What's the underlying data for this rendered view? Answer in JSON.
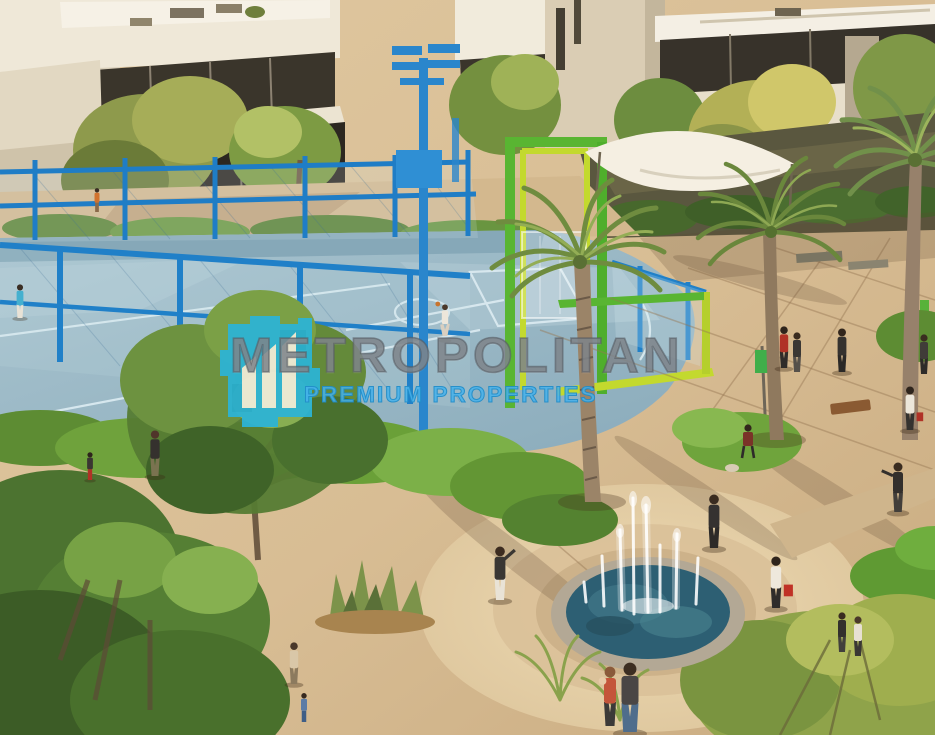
{
  "image": {
    "description": "Aerial architectural rendering of a residential community plaza: basketball court with blue fence, green hoop frame, palm trees, hedges, circular fountain plaza with pedestrians, modern villas in background",
    "kind": "real-estate marketing render with watermark"
  },
  "watermark": {
    "brand": "METROPOLITAN",
    "tagline": "PREMIUM PROPERTIES",
    "logo_icon": "buildings-logo-icon",
    "colors": {
      "logo_teal": "#2cb4d7",
      "logo_buildings_white": "#f2edda",
      "brand_gray": "#7b8086",
      "tagline_blue": "#2ea9e2"
    }
  },
  "scene": {
    "elements": [
      "villas",
      "basketball-court",
      "court-fence",
      "hoop-frame",
      "floodlight-pole",
      "shade-sail",
      "palm-trees",
      "hedges",
      "plaza",
      "fountain",
      "benches",
      "pedestrians"
    ],
    "palette": {
      "court_blue": "#98b7c4",
      "fence_blue": "#1f7dc6",
      "hoop_green": "#59b532",
      "hoop_lime": "#c3d92e",
      "pavement_tan": "#d8bf99",
      "foliage_green": "#5d8c33",
      "fountain_water": "#2d5f73",
      "building_cream": "#e9e1d0"
    }
  }
}
